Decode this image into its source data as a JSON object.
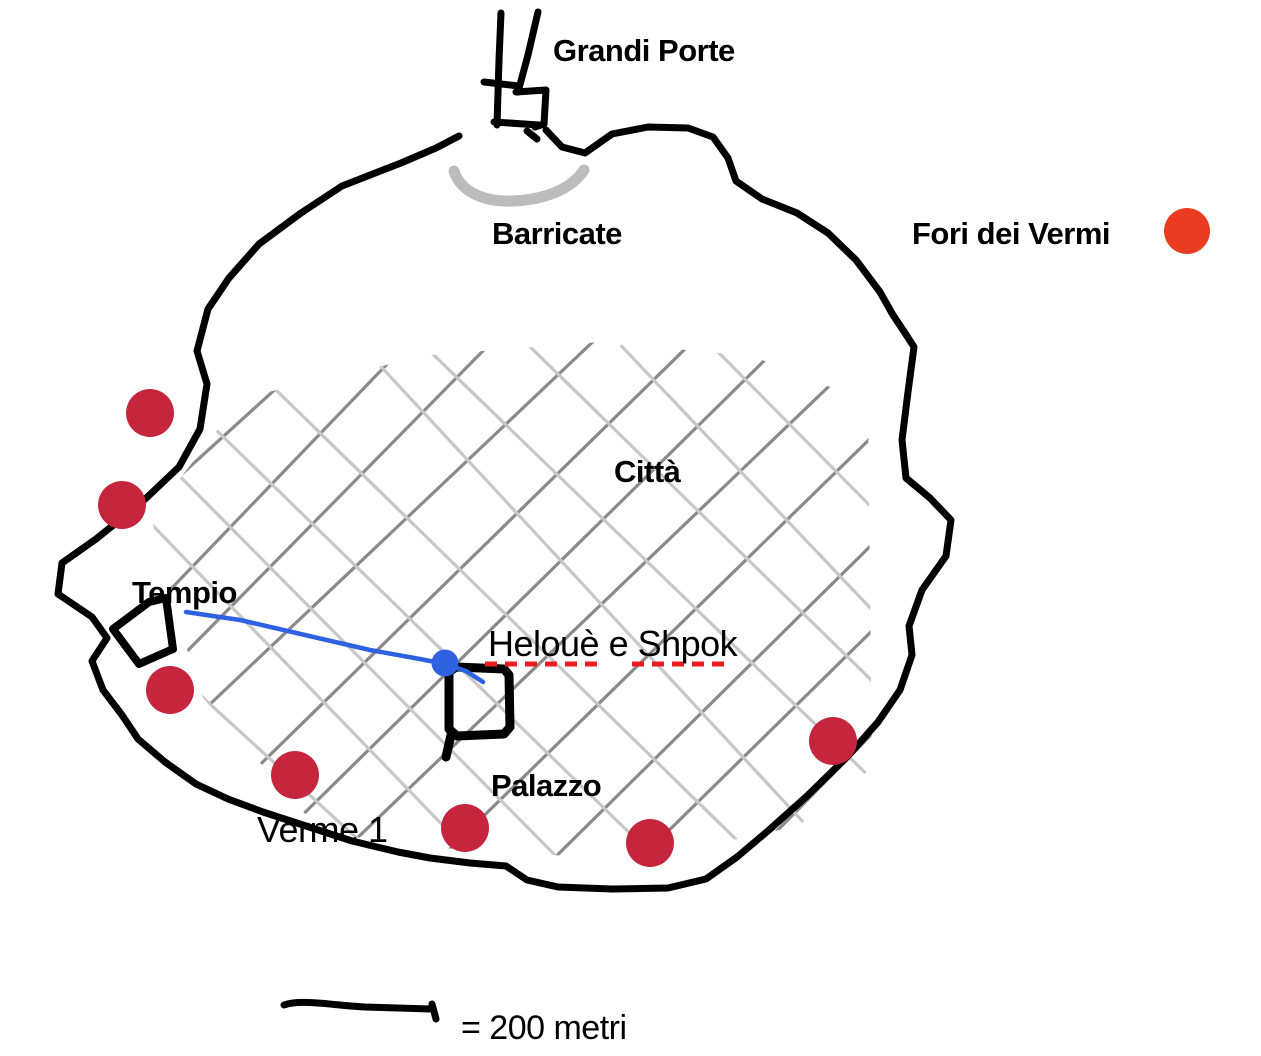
{
  "map": {
    "labels": {
      "gate": "Grandi Porte",
      "barricade": "Barricate",
      "city": "Città",
      "temple": "Tempio",
      "npc_location": "Helouè e Shpok",
      "palace": "Palazzo",
      "worm": "Verme 1"
    },
    "legend": {
      "label": "Fori dei Vermi"
    },
    "scale": {
      "label": "= 200 metri"
    },
    "worm_holes": {
      "radius": 24,
      "points": [
        {
          "x": 150,
          "y": 413
        },
        {
          "x": 122,
          "y": 505
        },
        {
          "x": 170,
          "y": 690
        },
        {
          "x": 295,
          "y": 775
        },
        {
          "x": 465,
          "y": 828
        },
        {
          "x": 650,
          "y": 843
        },
        {
          "x": 833,
          "y": 741
        }
      ]
    },
    "route": {
      "points": [
        [
          186,
          612
        ],
        [
          240,
          620
        ],
        [
          305,
          635
        ],
        [
          370,
          650
        ],
        [
          420,
          659
        ],
        [
          445,
          664
        ],
        [
          466,
          671
        ],
        [
          483,
          682
        ]
      ],
      "endpoint": {
        "x": 445,
        "y": 663,
        "r": 13.5
      }
    },
    "label_underline": {
      "segments": [
        [
          485,
          664,
          597,
          664
        ],
        [
          632,
          664,
          727,
          664
        ]
      ]
    },
    "street_grid": {
      "spacing": 96,
      "jitter": 14,
      "bbox": [
        140,
        340,
        880,
        872
      ],
      "stroke_width": 3.2
    }
  },
  "colors": {
    "background": "#ffffff",
    "ink": "#000000",
    "barricade": "#bcbcbc",
    "street_dark": "#8a8a8a",
    "street_light": "#c7c7c7",
    "worm_hole": "#c5263e",
    "legend_dot": "#e93c22",
    "route": "#2e62e0",
    "underline": "#ed1c24",
    "text": "#000000"
  }
}
